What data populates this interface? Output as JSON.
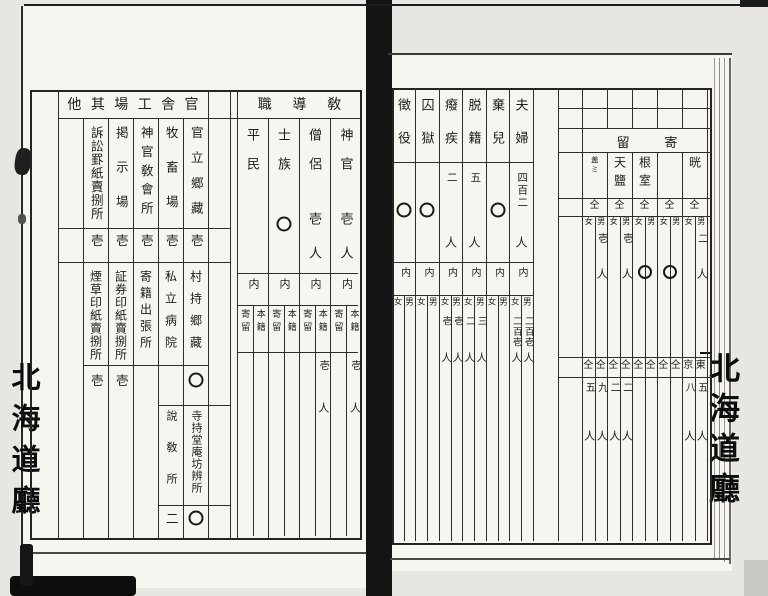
{
  "edge_stamps": {
    "left": "北海道廳",
    "right": "北海道廳"
  },
  "left_page": {
    "buildings_block": {
      "header": "官舎工場其他",
      "columns": [
        {
          "name1": "",
          "v1": "",
          "name2": "",
          "v2": "",
          "name3": "",
          "v3": ""
        },
        {
          "name1": "官立郷藏",
          "v1": "壱",
          "name2": "村持郷藏",
          "v2": "〇",
          "name3": "寺持堂庵坊辨所",
          "v3": "〇"
        },
        {
          "name1": "牧畜場",
          "v1": "壱",
          "name2": "私立病院",
          "v2": "",
          "name3": "說敎所",
          "v3": "二"
        },
        {
          "name1": "神官敎會所",
          "v1": "壱",
          "name2": "寄籍出張所",
          "v2": "",
          "name3": "",
          "v3": ""
        },
        {
          "name1": "掲示場",
          "v1": "壱",
          "name2": "証券印紙賣捌所",
          "v2": "壱",
          "name3": "",
          "v3": ""
        },
        {
          "name1": "訴訟罫紙賣捌所",
          "v1": "壱",
          "name2": "煙草印紙賣捌所",
          "v2": "壱",
          "name3": "",
          "v3": ""
        },
        {
          "name1": "",
          "v1": "",
          "name2": "",
          "v2": "",
          "name3": "",
          "v3": ""
        }
      ]
    },
    "clergy_block": {
      "header": "敎導職",
      "inner_label": "内",
      "sub_labels": {
        "right": "本籍",
        "left": "寄留"
      },
      "columns": [
        {
          "name": "神官",
          "total": "壱",
          "unit": "人",
          "honseki": "壱人",
          "kiryu": ""
        },
        {
          "name": "僧侶",
          "total": "壱",
          "unit": "人",
          "honseki": "壱人",
          "kiryu": ""
        },
        {
          "name": "士族",
          "total": "〇",
          "unit": "",
          "honseki": "",
          "kiryu": ""
        },
        {
          "name": "平民",
          "total": "",
          "unit": "",
          "honseki": "",
          "kiryu": ""
        }
      ]
    }
  },
  "right_page": {
    "population_block": {
      "inner_label": "内",
      "sub_labels": {
        "right": "男",
        "left": "女"
      },
      "columns": [
        {
          "name": "",
          "total": "",
          "unit": "",
          "male": "",
          "female": ""
        },
        {
          "name": "夫婦",
          "total": "四百二",
          "unit": "人",
          "male": "二百壱人",
          "female": "二百壱人"
        },
        {
          "name": "棄兒",
          "total": "〇",
          "unit": "",
          "male": "",
          "female": ""
        },
        {
          "name": "脱籍",
          "total": "五",
          "unit": "人",
          "male": "三人",
          "female": "二人"
        },
        {
          "name": "癈疾",
          "total": "二",
          "unit": "人",
          "male": "壱人",
          "female": "壱人"
        },
        {
          "name": "囚獄",
          "total": "〇",
          "unit": "",
          "male": "",
          "female": ""
        },
        {
          "name": "徴役",
          "total": "〇",
          "unit": "",
          "male": "",
          "female": ""
        }
      ]
    },
    "sojourn_block": {
      "header": "寄留",
      "sub_labels": {
        "right": "男",
        "left": "女"
      },
      "columns": [
        {
          "name": "晄",
          "ditto": "仝",
          "male": "二人",
          "female": ""
        },
        {
          "name": "",
          "ditto": "仝",
          "male": "〇",
          "female": ""
        },
        {
          "name": "根室",
          "ditto": "仝",
          "male": "〇",
          "female": ""
        },
        {
          "name": "天鹽",
          "ditto": "仝",
          "male": "壱人",
          "female": ""
        },
        {
          "name": "盖ミ",
          "ditto": "仝",
          "male": "壱人",
          "female": ""
        }
      ],
      "row2": [
        {
          "label": "東京",
          "male": "五人",
          "female": "八人"
        },
        {
          "label": "仝仝",
          "male": "",
          "female": ""
        },
        {
          "label": "仝仝",
          "male": "",
          "female": ""
        },
        {
          "label": "仝仝",
          "male": "二人",
          "female": "二人"
        },
        {
          "label": "仝仝",
          "male": "九人",
          "female": "五人"
        }
      ]
    }
  }
}
